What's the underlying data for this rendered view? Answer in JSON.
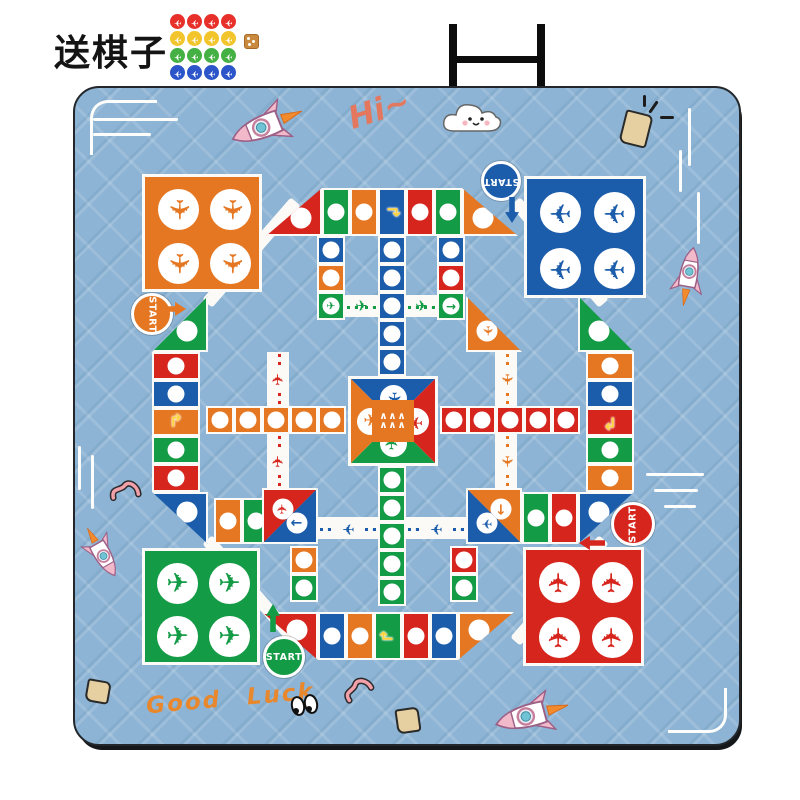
{
  "promo": {
    "title": "送棋子",
    "row_colors": [
      "#e8302a",
      "#f2c52c",
      "#45b043",
      "#2b55c8"
    ],
    "tokens_per_row": 4,
    "grid": {
      "x": 170,
      "y": 14,
      "step": 17
    },
    "dice": {
      "x": 244,
      "y": 34,
      "color": "#c98a3e"
    }
  },
  "stand": {
    "bars": [
      {
        "x": 449,
        "y": 24,
        "w": 8,
        "h": 64
      },
      {
        "x": 537,
        "y": 24,
        "w": 8,
        "h": 64
      },
      {
        "x": 449,
        "y": 56,
        "w": 96,
        "h": 7
      }
    ]
  },
  "mat": {
    "bg": "#8db4d5",
    "border": "#23272b"
  },
  "board": {
    "colors": {
      "O": "#e57722",
      "B": "#1b5cab",
      "R": "#d6251d",
      "G": "#149b46"
    },
    "start_label": "START",
    "hangars": [
      {
        "x": 142,
        "y": 174,
        "w": 120,
        "h": 118,
        "c": "O",
        "r": 90
      },
      {
        "x": 524,
        "y": 176,
        "w": 122,
        "h": 122,
        "c": "B",
        "r": 180
      },
      {
        "x": 142,
        "y": 548,
        "w": 118,
        "h": 117,
        "c": "G",
        "r": 0
      },
      {
        "x": 523,
        "y": 547,
        "w": 121,
        "h": 119,
        "c": "R",
        "r": 270
      }
    ],
    "bands": [
      {
        "x": 184,
        "y": 246,
        "w": 135,
        "h": 13,
        "r": -49
      },
      {
        "x": 492,
        "y": 246,
        "w": 135,
        "h": 13,
        "r": 49
      },
      {
        "x": 184,
        "y": 584,
        "w": 135,
        "h": 13,
        "r": 49
      },
      {
        "x": 492,
        "y": 584,
        "w": 135,
        "h": 13,
        "r": -49
      }
    ],
    "cells": [
      {
        "x": 266,
        "y": 188,
        "w": 56,
        "h": 48,
        "c": "R",
        "s": "br",
        "i": "c"
      },
      {
        "x": 322,
        "y": 188,
        "w": 28,
        "h": 48,
        "c": "G",
        "i": "c"
      },
      {
        "x": 350,
        "y": 188,
        "w": 28,
        "h": 48,
        "c": "O",
        "i": "c"
      },
      {
        "x": 378,
        "y": 188,
        "w": 28,
        "h": 48,
        "c": "B",
        "i": "t",
        "r": 90
      },
      {
        "x": 406,
        "y": 188,
        "w": 28,
        "h": 48,
        "c": "R",
        "i": "c"
      },
      {
        "x": 434,
        "y": 188,
        "w": 28,
        "h": 48,
        "c": "G",
        "i": "c"
      },
      {
        "x": 462,
        "y": 188,
        "w": 56,
        "h": 48,
        "c": "O",
        "s": "bl",
        "i": "c"
      },
      {
        "x": 152,
        "y": 296,
        "w": 56,
        "h": 56,
        "c": "G",
        "s": "br",
        "i": "c"
      },
      {
        "x": 152,
        "y": 352,
        "w": 48,
        "h": 28,
        "c": "R",
        "i": "c"
      },
      {
        "x": 152,
        "y": 380,
        "w": 48,
        "h": 28,
        "c": "B",
        "i": "c"
      },
      {
        "x": 152,
        "y": 408,
        "w": 48,
        "h": 28,
        "c": "O",
        "i": "t",
        "r": 0
      },
      {
        "x": 152,
        "y": 436,
        "w": 48,
        "h": 28,
        "c": "G",
        "i": "c"
      },
      {
        "x": 152,
        "y": 464,
        "w": 48,
        "h": 28,
        "c": "R",
        "i": "c"
      },
      {
        "x": 152,
        "y": 492,
        "w": 56,
        "h": 52,
        "c": "B",
        "s": "tr",
        "i": "c"
      },
      {
        "x": 578,
        "y": 296,
        "w": 56,
        "h": 56,
        "c": "G",
        "s": "bl",
        "i": "c"
      },
      {
        "x": 586,
        "y": 352,
        "w": 48,
        "h": 28,
        "c": "O",
        "i": "c"
      },
      {
        "x": 586,
        "y": 380,
        "w": 48,
        "h": 28,
        "c": "B",
        "i": "c"
      },
      {
        "x": 586,
        "y": 408,
        "w": 48,
        "h": 28,
        "c": "R",
        "i": "t",
        "r": 180
      },
      {
        "x": 586,
        "y": 436,
        "w": 48,
        "h": 28,
        "c": "G",
        "i": "c"
      },
      {
        "x": 586,
        "y": 464,
        "w": 48,
        "h": 28,
        "c": "O",
        "i": "c"
      },
      {
        "x": 578,
        "y": 492,
        "w": 56,
        "h": 52,
        "c": "B",
        "s": "tl",
        "i": "c"
      },
      {
        "x": 262,
        "y": 612,
        "w": 56,
        "h": 48,
        "c": "R",
        "s": "tr",
        "i": "c"
      },
      {
        "x": 318,
        "y": 612,
        "w": 28,
        "h": 48,
        "c": "B",
        "i": "c"
      },
      {
        "x": 346,
        "y": 612,
        "w": 28,
        "h": 48,
        "c": "O",
        "i": "c"
      },
      {
        "x": 374,
        "y": 612,
        "w": 28,
        "h": 48,
        "c": "G",
        "i": "t",
        "r": 270
      },
      {
        "x": 402,
        "y": 612,
        "w": 28,
        "h": 48,
        "c": "R",
        "i": "c"
      },
      {
        "x": 430,
        "y": 612,
        "w": 28,
        "h": 48,
        "c": "B",
        "i": "c"
      },
      {
        "x": 458,
        "y": 612,
        "w": 56,
        "h": 48,
        "c": "O",
        "s": "tl",
        "i": "c"
      },
      {
        "x": 317,
        "y": 236,
        "w": 28,
        "h": 28,
        "c": "B",
        "i": "c"
      },
      {
        "x": 317,
        "y": 264,
        "w": 28,
        "h": 28,
        "c": "O",
        "i": "c"
      },
      {
        "x": 317,
        "y": 292,
        "w": 28,
        "h": 28,
        "c": "G",
        "i": "p",
        "r": 0
      },
      {
        "x": 437,
        "y": 236,
        "w": 28,
        "h": 28,
        "c": "B",
        "i": "c"
      },
      {
        "x": 437,
        "y": 264,
        "w": 28,
        "h": 28,
        "c": "R",
        "i": "c"
      },
      {
        "x": 437,
        "y": 292,
        "w": 28,
        "h": 28,
        "c": "G",
        "i": "a",
        "r": 0
      },
      {
        "x": 466,
        "y": 296,
        "w": 56,
        "h": 56,
        "c": "O",
        "s": "bl",
        "i": "p",
        "r": 90
      },
      {
        "x": 214,
        "y": 498,
        "w": 28,
        "h": 46,
        "c": "O",
        "i": "c"
      },
      {
        "x": 242,
        "y": 498,
        "w": 28,
        "h": 46,
        "c": "G",
        "i": "c"
      },
      {
        "x": 522,
        "y": 492,
        "w": 28,
        "h": 52,
        "c": "G",
        "i": "c"
      },
      {
        "x": 550,
        "y": 492,
        "w": 28,
        "h": 52,
        "c": "R",
        "i": "c"
      },
      {
        "x": 262,
        "y": 488,
        "w": 56,
        "h": 56,
        "c": "R",
        "s": "tl",
        "i": "p",
        "r": -90
      },
      {
        "x": 262,
        "y": 488,
        "w": 56,
        "h": 56,
        "c": "B",
        "s": "br",
        "i": "a",
        "r": 180
      },
      {
        "x": 466,
        "y": 488,
        "w": 56,
        "h": 56,
        "c": "O",
        "s": "tr",
        "i": "a",
        "r": 90
      },
      {
        "x": 466,
        "y": 488,
        "w": 56,
        "h": 56,
        "c": "B",
        "s": "bl",
        "i": "p",
        "r": 180
      },
      {
        "x": 290,
        "y": 546,
        "w": 28,
        "h": 28,
        "c": "O",
        "i": "c"
      },
      {
        "x": 290,
        "y": 574,
        "w": 28,
        "h": 28,
        "c": "G",
        "i": "c"
      },
      {
        "x": 450,
        "y": 546,
        "w": 28,
        "h": 28,
        "c": "R",
        "i": "c"
      },
      {
        "x": 450,
        "y": 574,
        "w": 28,
        "h": 28,
        "c": "G",
        "i": "c"
      },
      {
        "x": 378,
        "y": 236,
        "w": 28,
        "h": 28,
        "c": "B",
        "i": "c"
      },
      {
        "x": 378,
        "y": 264,
        "w": 28,
        "h": 28,
        "c": "B",
        "i": "c"
      },
      {
        "x": 378,
        "y": 292,
        "w": 28,
        "h": 28,
        "c": "B",
        "i": "c"
      },
      {
        "x": 378,
        "y": 320,
        "w": 28,
        "h": 28,
        "c": "B",
        "i": "c"
      },
      {
        "x": 378,
        "y": 348,
        "w": 28,
        "h": 28,
        "c": "B",
        "i": "c"
      },
      {
        "x": 378,
        "y": 466,
        "w": 28,
        "h": 28,
        "c": "G",
        "i": "c"
      },
      {
        "x": 378,
        "y": 494,
        "w": 28,
        "h": 28,
        "c": "G",
        "i": "c"
      },
      {
        "x": 378,
        "y": 522,
        "w": 28,
        "h": 28,
        "c": "G",
        "i": "c"
      },
      {
        "x": 378,
        "y": 550,
        "w": 28,
        "h": 28,
        "c": "G",
        "i": "c"
      },
      {
        "x": 378,
        "y": 578,
        "w": 28,
        "h": 28,
        "c": "G",
        "i": "c"
      },
      {
        "x": 206,
        "y": 406,
        "w": 28,
        "h": 28,
        "c": "O",
        "i": "c"
      },
      {
        "x": 234,
        "y": 406,
        "w": 28,
        "h": 28,
        "c": "O",
        "i": "c"
      },
      {
        "x": 262,
        "y": 406,
        "w": 28,
        "h": 28,
        "c": "O",
        "i": "c"
      },
      {
        "x": 290,
        "y": 406,
        "w": 28,
        "h": 28,
        "c": "O",
        "i": "c"
      },
      {
        "x": 318,
        "y": 406,
        "w": 28,
        "h": 28,
        "c": "O",
        "i": "c"
      },
      {
        "x": 440,
        "y": 406,
        "w": 28,
        "h": 28,
        "c": "R",
        "i": "c"
      },
      {
        "x": 468,
        "y": 406,
        "w": 28,
        "h": 28,
        "c": "R",
        "i": "c"
      },
      {
        "x": 496,
        "y": 406,
        "w": 28,
        "h": 28,
        "c": "R",
        "i": "c"
      },
      {
        "x": 524,
        "y": 406,
        "w": 28,
        "h": 28,
        "c": "R",
        "i": "c"
      },
      {
        "x": 552,
        "y": 406,
        "w": 28,
        "h": 28,
        "c": "R",
        "i": "c"
      }
    ],
    "roads": [
      {
        "x": 345,
        "y": 295,
        "w": 33,
        "h": 22,
        "c": "G",
        "d": "h",
        "r": 0
      },
      {
        "x": 406,
        "y": 295,
        "w": 31,
        "h": 22,
        "c": "G",
        "d": "h",
        "r": 0
      },
      {
        "x": 318,
        "y": 517,
        "w": 60,
        "h": 22,
        "c": "B",
        "d": "h",
        "r": 180
      },
      {
        "x": 406,
        "y": 517,
        "w": 60,
        "h": 22,
        "c": "B",
        "d": "h",
        "r": 180
      },
      {
        "x": 267,
        "y": 352,
        "w": 22,
        "h": 54,
        "c": "R",
        "d": "v",
        "r": -90
      },
      {
        "x": 267,
        "y": 434,
        "w": 22,
        "h": 54,
        "c": "R",
        "d": "v",
        "r": -90
      },
      {
        "x": 495,
        "y": 352,
        "w": 22,
        "h": 54,
        "c": "O",
        "d": "v",
        "r": 90
      },
      {
        "x": 495,
        "y": 434,
        "w": 22,
        "h": 54,
        "c": "O",
        "d": "v",
        "r": 90
      }
    ],
    "center": {
      "x": 348,
      "y": 376,
      "s": 90,
      "core": "O",
      "tris": [
        {
          "k": "t",
          "c": "B",
          "r": 90
        },
        {
          "k": "r",
          "c": "R",
          "r": 180
        },
        {
          "k": "b",
          "c": "G",
          "r": 270
        },
        {
          "k": "l",
          "c": "O",
          "r": 0
        }
      ]
    },
    "starts": [
      {
        "x": 131,
        "y": 293,
        "d": 42,
        "c": "O",
        "rot": 90,
        "arrow": {
          "x": 166,
          "y": 296,
          "w": 26,
          "h": 14,
          "r": 90
        }
      },
      {
        "x": 481,
        "y": 161,
        "d": 40,
        "c": "B",
        "rot": 180,
        "arrow": {
          "x": 505,
          "y": 197,
          "w": 14,
          "h": 26,
          "r": 180
        }
      },
      {
        "x": 263,
        "y": 636,
        "d": 42,
        "c": "G",
        "rot": 0,
        "arrow": {
          "x": 266,
          "y": 604,
          "w": 14,
          "h": 28,
          "r": 0
        }
      },
      {
        "x": 611,
        "y": 502,
        "d": 44,
        "c": "R",
        "rot": -90,
        "arrow": {
          "x": 585,
          "y": 530,
          "w": 26,
          "h": 14,
          "r": 270
        }
      }
    ]
  },
  "decorations": {
    "hi_text": "Hi~",
    "good_luck_text": "Good Luck",
    "hi_pos": {
      "x": 348,
      "y": 92,
      "r": -18
    },
    "good_luck_pos": {
      "x": 146,
      "y": 686,
      "r": -5
    },
    "cloud": {
      "x": 440,
      "y": 96,
      "w": 64,
      "h": 44
    },
    "eyes": {
      "x": 289,
      "y": 692
    },
    "rockets": [
      {
        "x": 248,
        "y": 78,
        "s": 0.95,
        "r": -112
      },
      {
        "x": 666,
        "y": 233,
        "s": 0.75,
        "r": 10
      },
      {
        "x": 78,
        "y": 504,
        "s": 0.7,
        "r": 150
      },
      {
        "x": 513,
        "y": 668,
        "s": 0.95,
        "r": -105
      }
    ],
    "worms": [
      {
        "x": 108,
        "y": 478,
        "r": 10
      },
      {
        "x": 342,
        "y": 676,
        "r": -12
      }
    ],
    "lines": [
      {
        "x": 93,
        "y": 118,
        "w": 85,
        "h": 3
      },
      {
        "x": 93,
        "y": 133,
        "w": 58,
        "h": 3
      },
      {
        "x": 688,
        "y": 108,
        "w": 3,
        "h": 58
      },
      {
        "x": 679,
        "y": 150,
        "w": 3,
        "h": 42
      },
      {
        "x": 697,
        "y": 192,
        "w": 3,
        "h": 52
      },
      {
        "x": 78,
        "y": 446,
        "w": 3,
        "h": 44
      },
      {
        "x": 91,
        "y": 455,
        "w": 3,
        "h": 54
      },
      {
        "x": 646,
        "y": 473,
        "w": 58,
        "h": 3
      },
      {
        "x": 654,
        "y": 489,
        "w": 44,
        "h": 3
      },
      {
        "x": 664,
        "y": 505,
        "w": 32,
        "h": 3
      }
    ],
    "brackets": [
      {
        "x": 90,
        "y": 100,
        "w": 64,
        "h": 52,
        "side": "tl"
      },
      {
        "x": 668,
        "y": 688,
        "w": 56,
        "h": 42,
        "side": "br"
      }
    ],
    "scraps": [
      {
        "x": 86,
        "y": 680,
        "w": 20,
        "h": 19,
        "r": 10
      },
      {
        "x": 396,
        "y": 708,
        "w": 20,
        "h": 21,
        "r": -8
      },
      {
        "x": 622,
        "y": 112,
        "w": 24,
        "h": 30,
        "r": 14
      }
    ],
    "sparks": [
      {
        "x": 652,
        "y": 100,
        "w": 3,
        "h": 14,
        "r": 35
      },
      {
        "x": 660,
        "y": 116,
        "w": 14,
        "h": 3,
        "r": 0
      },
      {
        "x": 643,
        "y": 95,
        "w": 3,
        "h": 12,
        "r": 0
      }
    ]
  }
}
